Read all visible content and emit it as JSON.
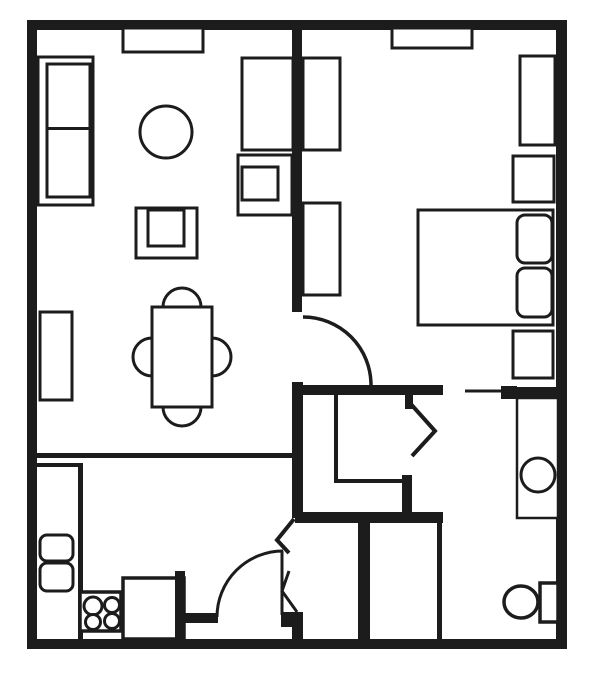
{
  "meta": {
    "width": 600,
    "height": 673,
    "background": "#ffffff",
    "ink": "#1c1c1c"
  },
  "shapes": [
    {
      "type": "wall",
      "name": "outer-wall-top",
      "x": 27,
      "y": 20,
      "w": 540,
      "h": 10
    },
    {
      "type": "wall",
      "name": "outer-wall-left",
      "x": 27,
      "y": 20,
      "w": 10,
      "h": 629
    },
    {
      "type": "wall",
      "name": "outer-wall-bottom",
      "x": 27,
      "y": 639,
      "w": 540,
      "h": 10
    },
    {
      "type": "wall",
      "name": "outer-wall-right",
      "x": 556,
      "y": 20,
      "w": 11,
      "h": 629
    },
    {
      "type": "wall",
      "name": "bedroom-divider-wall",
      "x": 292,
      "y": 28,
      "w": 10,
      "h": 284
    },
    {
      "type": "wall",
      "name": "bedroom-bottom-wall",
      "x": 292,
      "y": 385,
      "w": 151,
      "h": 10
    },
    {
      "type": "wall",
      "name": "bathroom-door-block",
      "x": 501,
      "y": 386,
      "w": 16,
      "h": 13
    },
    {
      "type": "wall",
      "name": "bedroom-bottom-wall-right",
      "x": 517,
      "y": 387,
      "w": 40,
      "h": 10
    },
    {
      "type": "wall",
      "name": "hall-vertical-wall",
      "x": 292,
      "y": 382,
      "w": 11,
      "h": 136
    },
    {
      "type": "wall",
      "name": "hall-horizontal-wall",
      "x": 295,
      "y": 512,
      "w": 148,
      "h": 11
    },
    {
      "type": "wall",
      "name": "closet-corner-post",
      "x": 402,
      "y": 475,
      "w": 10,
      "h": 43
    },
    {
      "type": "wall",
      "name": "bifold-door-stub",
      "x": 405,
      "y": 395,
      "w": 8,
      "h": 14
    },
    {
      "type": "wall",
      "name": "entry-closet-left-wall",
      "x": 358,
      "y": 515,
      "w": 12,
      "h": 133
    },
    {
      "type": "wall",
      "name": "entry-door-block",
      "x": 281,
      "y": 612,
      "w": 22,
      "h": 15
    },
    {
      "type": "wall",
      "name": "entry-lower-wall",
      "x": 292,
      "y": 613,
      "w": 11,
      "h": 35
    },
    {
      "type": "line-rect",
      "name": "kitchen-divider-halfwall",
      "x": 36,
      "y": 453,
      "w": 259,
      "h": 5
    },
    {
      "type": "line-rect",
      "name": "counter-edge-right",
      "x": 78,
      "y": 463,
      "w": 5,
      "h": 176
    },
    {
      "type": "line-rect",
      "name": "counter-edge-top",
      "x": 36,
      "y": 463,
      "w": 47,
      "h": 4
    },
    {
      "type": "line-rect",
      "name": "hall-closet-wall-left",
      "x": 334,
      "y": 395,
      "w": 4,
      "h": 87
    },
    {
      "type": "line-rect",
      "name": "hall-closet-wall-bottom",
      "x": 334,
      "y": 479,
      "w": 72,
      "h": 4
    },
    {
      "type": "line-rect",
      "name": "entry-closet-right-wall",
      "x": 437,
      "y": 523,
      "w": 5,
      "h": 116
    },
    {
      "type": "path",
      "name": "bedroom-door-arc",
      "d": "M 303 317 A 68 68 0 0 1 371 385",
      "sw": 3.5
    },
    {
      "type": "polyline",
      "name": "closet-bifold-door",
      "pts": "409,402 435,431 412,456",
      "sw": 4
    },
    {
      "type": "path",
      "name": "bathroom-door-leaf",
      "d": "M 465 391 L 503 391",
      "sw": 3
    },
    {
      "type": "path",
      "name": "entry-door-arc",
      "d": "M 217 617 A 66 66 0 0 1 283 551",
      "sw": 3
    },
    {
      "type": "path",
      "name": "entry-door-leaf",
      "d": "M 282 551 L 282 615",
      "sw": 3
    },
    {
      "type": "polyline",
      "name": "entry-bifold-upper",
      "pts": "294,519 277,540 289,553",
      "sw": 4
    },
    {
      "type": "polyline",
      "name": "entry-bifold-lower",
      "pts": "289,571 282,591 297,612",
      "sw": 3
    },
    {
      "type": "box",
      "name": "living-wall-shelf",
      "x": 123,
      "y": 28,
      "w": 80,
      "h": 24,
      "sw": 3
    },
    {
      "type": "box",
      "name": "sofa-outer",
      "x": 38,
      "y": 57,
      "w": 55,
      "h": 148,
      "sw": 3
    },
    {
      "type": "box",
      "name": "sofa-cushions",
      "x": 47,
      "y": 64,
      "w": 43,
      "h": 133,
      "sw": 3
    },
    {
      "type": "line-rect",
      "name": "sofa-cushion-divider",
      "x": 47,
      "y": 127,
      "w": 43,
      "h": 3
    },
    {
      "type": "circle",
      "name": "round-side-table",
      "cx": 166,
      "cy": 132,
      "r": 26,
      "sw": 3
    },
    {
      "type": "box",
      "name": "media-console",
      "x": 242,
      "y": 58,
      "w": 51,
      "h": 92,
      "sw": 3
    },
    {
      "type": "box",
      "name": "tv-stand-outer",
      "x": 238,
      "y": 155,
      "w": 54,
      "h": 60,
      "sw": 3
    },
    {
      "type": "box",
      "name": "tv-stand-inner",
      "x": 242,
      "y": 167,
      "w": 36,
      "h": 33,
      "sw": 3
    },
    {
      "type": "box",
      "name": "armchair-outer",
      "x": 136,
      "y": 208,
      "w": 61,
      "h": 50,
      "sw": 3
    },
    {
      "type": "box",
      "name": "armchair-inner",
      "x": 148,
      "y": 210,
      "w": 36,
      "h": 36,
      "sw": 3
    },
    {
      "type": "box",
      "name": "living-side-shelf",
      "x": 40,
      "y": 312,
      "w": 32,
      "h": 88,
      "sw": 3
    },
    {
      "type": "path",
      "name": "dining-chair-top",
      "d": "M 163 307 A 19 19 0 0 1 201 307",
      "sw": 3
    },
    {
      "type": "path",
      "name": "dining-chair-bottom",
      "d": "M 201 407 A 19 19 0 0 1 163 407",
      "sw": 3
    },
    {
      "type": "path",
      "name": "dining-chair-left",
      "d": "M 152 338 A 19 19 0 0 0 152 376",
      "sw": 3
    },
    {
      "type": "path",
      "name": "dining-chair-right",
      "d": "M 212 338 A 19 19 0 0 1 212 376",
      "sw": 3
    },
    {
      "type": "box",
      "name": "dining-table",
      "x": 152,
      "y": 307,
      "w": 60,
      "h": 100,
      "sw": 3
    },
    {
      "type": "box",
      "name": "bedroom-wall-shelf",
      "x": 392,
      "y": 28,
      "w": 80,
      "h": 20,
      "sw": 3
    },
    {
      "type": "box",
      "name": "bedroom-dresser-upper",
      "x": 303,
      "y": 58,
      "w": 37,
      "h": 92,
      "sw": 3
    },
    {
      "type": "box",
      "name": "bedroom-dresser-lower",
      "x": 303,
      "y": 203,
      "w": 37,
      "h": 92,
      "sw": 3
    },
    {
      "type": "box",
      "name": "bedroom-tall-dresser",
      "x": 520,
      "y": 56,
      "w": 35,
      "h": 89,
      "sw": 3
    },
    {
      "type": "box",
      "name": "bedroom-cabinet",
      "x": 513,
      "y": 156,
      "w": 41,
      "h": 46,
      "sw": 3
    },
    {
      "type": "box",
      "name": "bed",
      "x": 418,
      "y": 210,
      "w": 135,
      "h": 115,
      "sw": 3
    },
    {
      "type": "rrect",
      "name": "bed-pillow-1",
      "x": 517,
      "y": 215,
      "w": 35,
      "h": 48,
      "r": 8,
      "sw": 3
    },
    {
      "type": "rrect",
      "name": "bed-pillow-2",
      "x": 517,
      "y": 268,
      "w": 35,
      "h": 49,
      "r": 8,
      "sw": 3
    },
    {
      "type": "box",
      "name": "nightstand",
      "x": 513,
      "y": 331,
      "w": 40,
      "h": 47,
      "sw": 3
    },
    {
      "type": "box",
      "name": "bathroom-vanity",
      "x": 517,
      "y": 398,
      "w": 41,
      "h": 120,
      "sw": 2.5
    },
    {
      "type": "circle",
      "name": "bathroom-sink",
      "cx": 538,
      "cy": 475,
      "r": 17,
      "sw": 3
    },
    {
      "type": "ellipse",
      "name": "toilet-bowl",
      "cx": 521,
      "cy": 602,
      "rx": 17,
      "ry": 16,
      "sw": 3.5
    },
    {
      "type": "box",
      "name": "toilet-tank",
      "x": 540,
      "y": 583,
      "w": 18,
      "h": 39,
      "sw": 3.5
    },
    {
      "type": "rrect",
      "name": "kitchen-sink-basin-1",
      "x": 40,
      "y": 535,
      "w": 33,
      "h": 26,
      "r": 7,
      "sw": 3
    },
    {
      "type": "rrect",
      "name": "kitchen-sink-basin-2",
      "x": 40,
      "y": 563,
      "w": 33,
      "h": 28,
      "r": 7,
      "sw": 3
    },
    {
      "type": "box",
      "name": "stove",
      "x": 80,
      "y": 592,
      "w": 41,
      "h": 39,
      "sw": 3.5
    },
    {
      "type": "circle",
      "name": "stove-burner-1",
      "cx": 93,
      "cy": 606,
      "r": 9,
      "sw": 3
    },
    {
      "type": "circle",
      "name": "stove-burner-2",
      "cx": 112,
      "cy": 605,
      "r": 7.5,
      "sw": 3
    },
    {
      "type": "circle",
      "name": "stove-burner-3",
      "cx": 93,
      "cy": 622,
      "r": 7.5,
      "sw": 3
    },
    {
      "type": "circle",
      "name": "stove-burner-4",
      "cx": 112,
      "cy": 621,
      "r": 7.5,
      "sw": 3
    },
    {
      "type": "box",
      "name": "pantry",
      "x": 123,
      "y": 578,
      "w": 61,
      "h": 61,
      "sw": 3.5
    },
    {
      "type": "wall",
      "name": "pantry-right-wall",
      "x": 175,
      "y": 571,
      "w": 10,
      "h": 68
    },
    {
      "type": "wall",
      "name": "kitchen-door-stub",
      "x": 183,
      "y": 613,
      "w": 35,
      "h": 10
    }
  ]
}
